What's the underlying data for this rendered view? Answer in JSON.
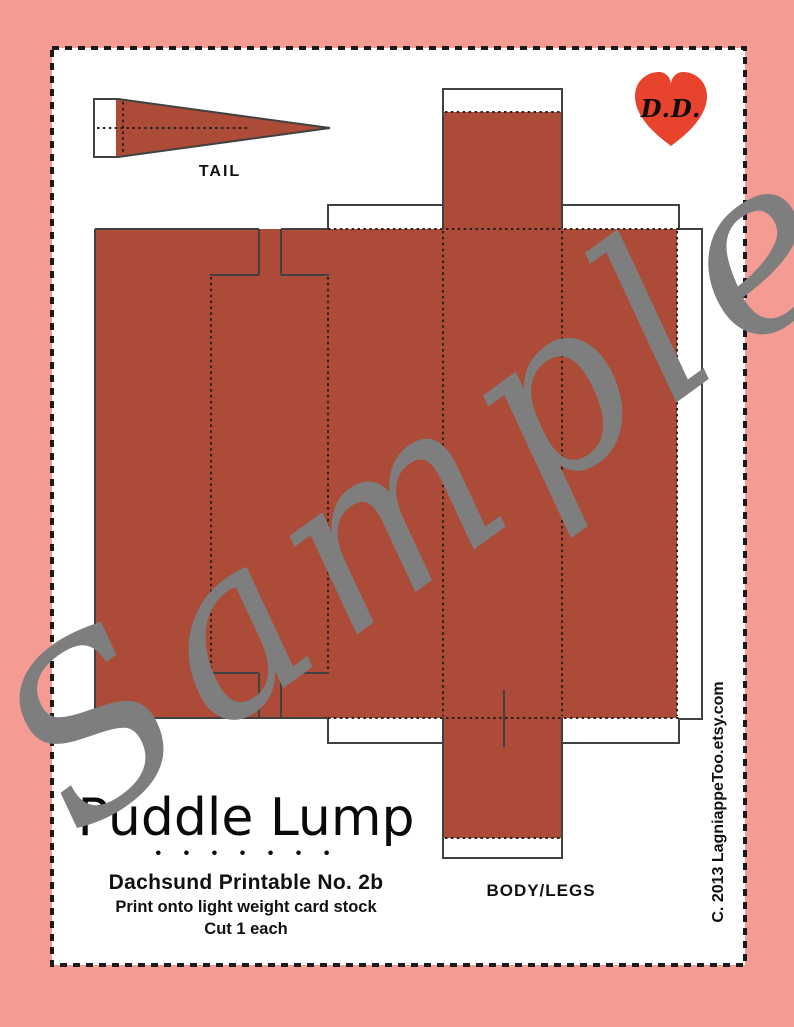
{
  "document": {
    "watermark": "Sample",
    "copyright": "C. 2013 LagniappeToo.etsy.com"
  },
  "pieces": {
    "tail_label": "TAIL",
    "body_label": "BODY/LEGS"
  },
  "heart": {
    "monogram": "D.D."
  },
  "footer": {
    "brand": "Puddle Lump",
    "dots": "• • • • • • •",
    "title": "Dachsund Printable No. 2b",
    "line1": "Print onto light weight card stock",
    "line2": "Cut 1 each"
  },
  "colors": {
    "background_pink": "#F49B93",
    "template_rust": "#AC4B37",
    "heart_red": "#E8432C",
    "watermark_gray": "#7E7E7E"
  }
}
